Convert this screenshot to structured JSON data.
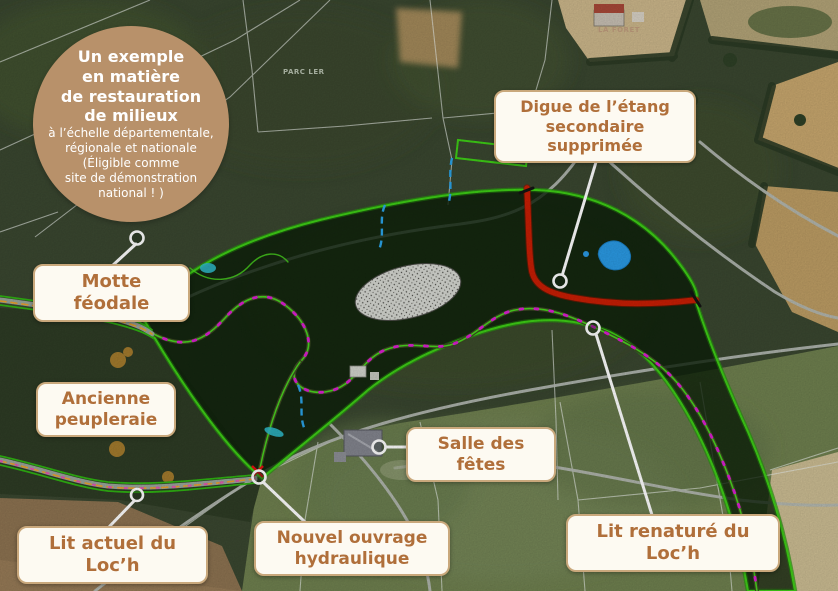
{
  "badge": {
    "title_lines": [
      "Un exemple",
      "en matière",
      "de restauration",
      "de milieux"
    ],
    "subtitle_lines": [
      "à l’échelle départementale,",
      "régionale et nationale",
      "(Éligible comme",
      "site de démonstration",
      "national ! )"
    ]
  },
  "labels": {
    "motte": "Motte féodale",
    "ancienne": "Ancienne peupleraie",
    "lit_actuel": "Lit actuel du Loc’h",
    "nouvel_ouvrage": "Nouvel ouvrage hydraulique",
    "salle": "Salle des fêtes",
    "digue": "Digue de l’étang secondaire supprimée",
    "lit_renature": "Lit renaturé du Loc’h"
  },
  "map_labels": {
    "parc": "PARC LER",
    "foret": "LA FORET"
  },
  "colors": {
    "badge_bg": "#b8916a",
    "label_bg": "#fdfaf2",
    "label_border": "#c9a87c",
    "label_text": "#b06f3a",
    "wetland_outline_green": "#3ecf16",
    "dike_red": "#c81e04",
    "stream_magenta": "#dc1ed2",
    "stream_orange": "#eca22c",
    "water_blue": "#2a9ae4",
    "leader_white": "#ffffff"
  }
}
